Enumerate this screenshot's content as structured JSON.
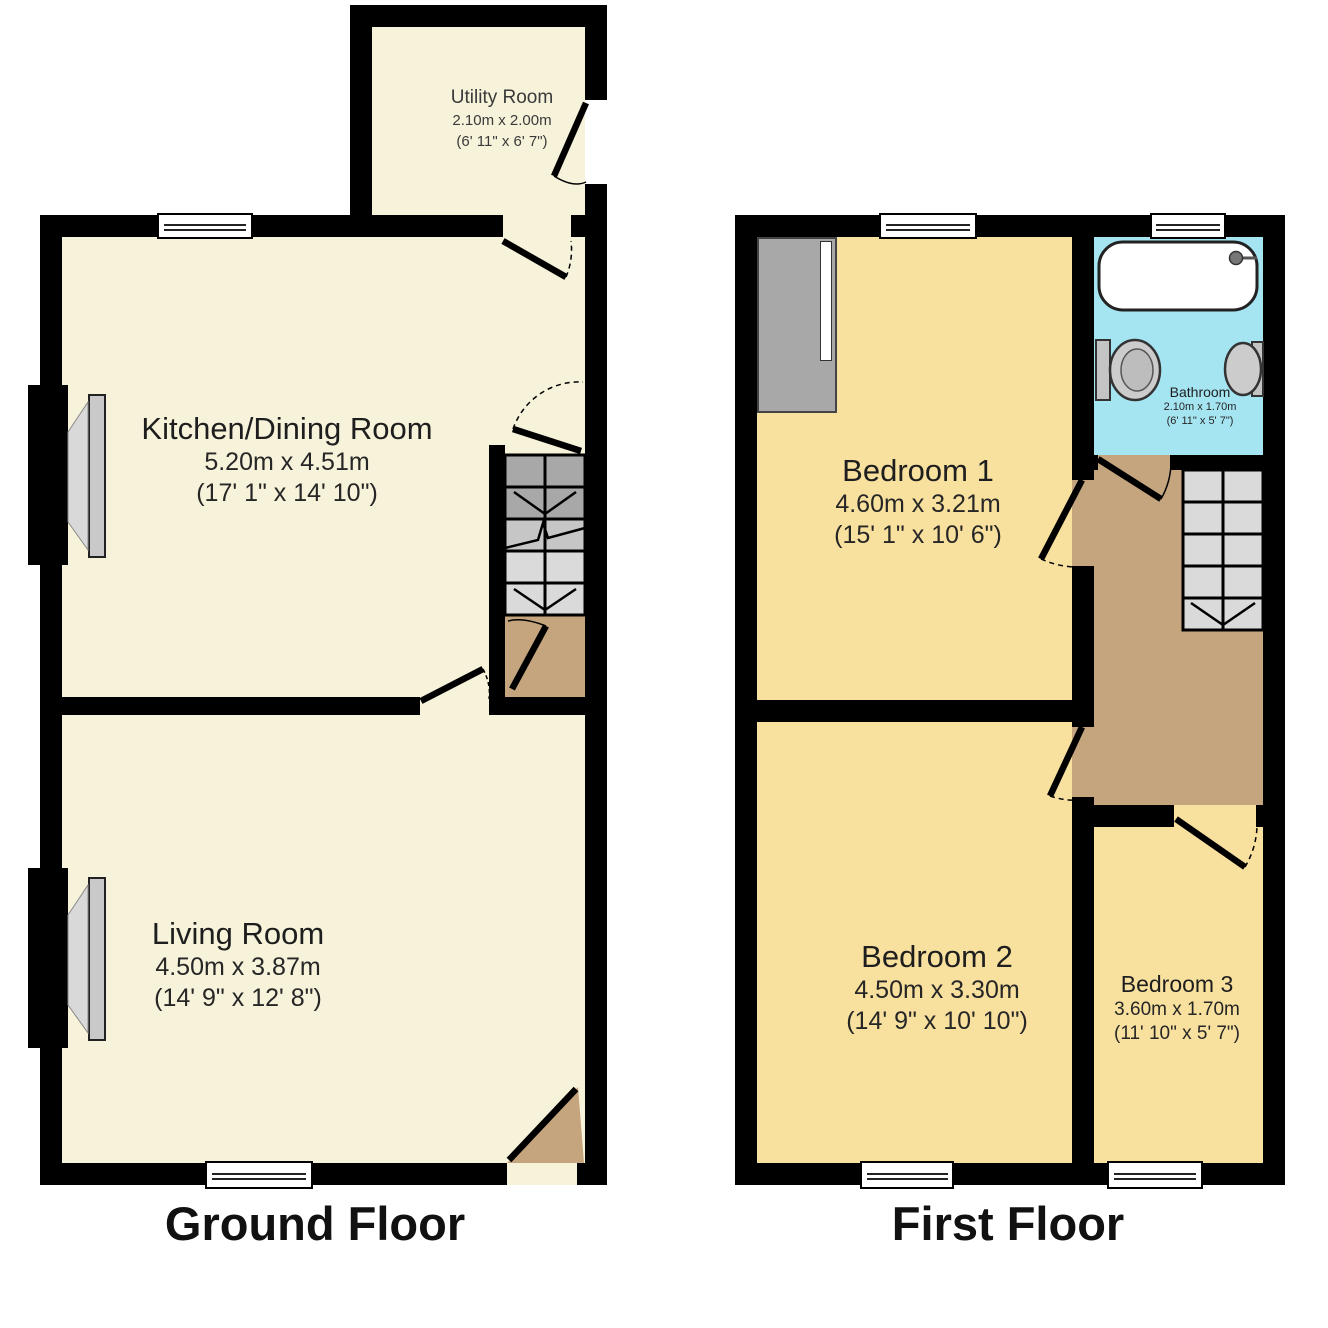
{
  "ground_floor": {
    "label": "Ground Floor",
    "utility": {
      "name": "Utility Room",
      "dims_m": "2.10m x 2.00m",
      "dims_ft": "(6' 11\" x 6' 7\")"
    },
    "kitchen": {
      "name": "Kitchen/Dining Room",
      "dims_m": "5.20m x 4.51m",
      "dims_ft": "(17' 1\" x 14' 10\")"
    },
    "living": {
      "name": "Living Room",
      "dims_m": "4.50m x 3.87m",
      "dims_ft": "(14' 9\" x 12' 8\")"
    }
  },
  "first_floor": {
    "label": "First Floor",
    "bedroom1": {
      "name": "Bedroom 1",
      "dims_m": "4.60m x 3.21m",
      "dims_ft": "(15' 1\" x 10' 6\")"
    },
    "bathroom": {
      "name": "Bathroom",
      "dims_m": "2.10m x 1.70m",
      "dims_ft": "(6' 11\" x 5' 7\")"
    },
    "bedroom2": {
      "name": "Bedroom 2",
      "dims_m": "4.50m x 3.30m",
      "dims_ft": "(14' 9\" x 10' 10\")"
    },
    "bedroom3": {
      "name": "Bedroom 3",
      "dims_m": "3.60m x 1.70m",
      "dims_ft": "(11' 10\" x 5' 7\")"
    }
  },
  "colors": {
    "wall": "#000000",
    "room_cream": "#F7F2DA",
    "room_wheat": "#F8E09E",
    "bathroom_blue": "#A5E5F2",
    "hall_tan": "#C5A57D",
    "stairs_light": "#DADADA",
    "stairs_dark": "#A8A8A8",
    "fixture_gray": "#CCCCCC"
  }
}
